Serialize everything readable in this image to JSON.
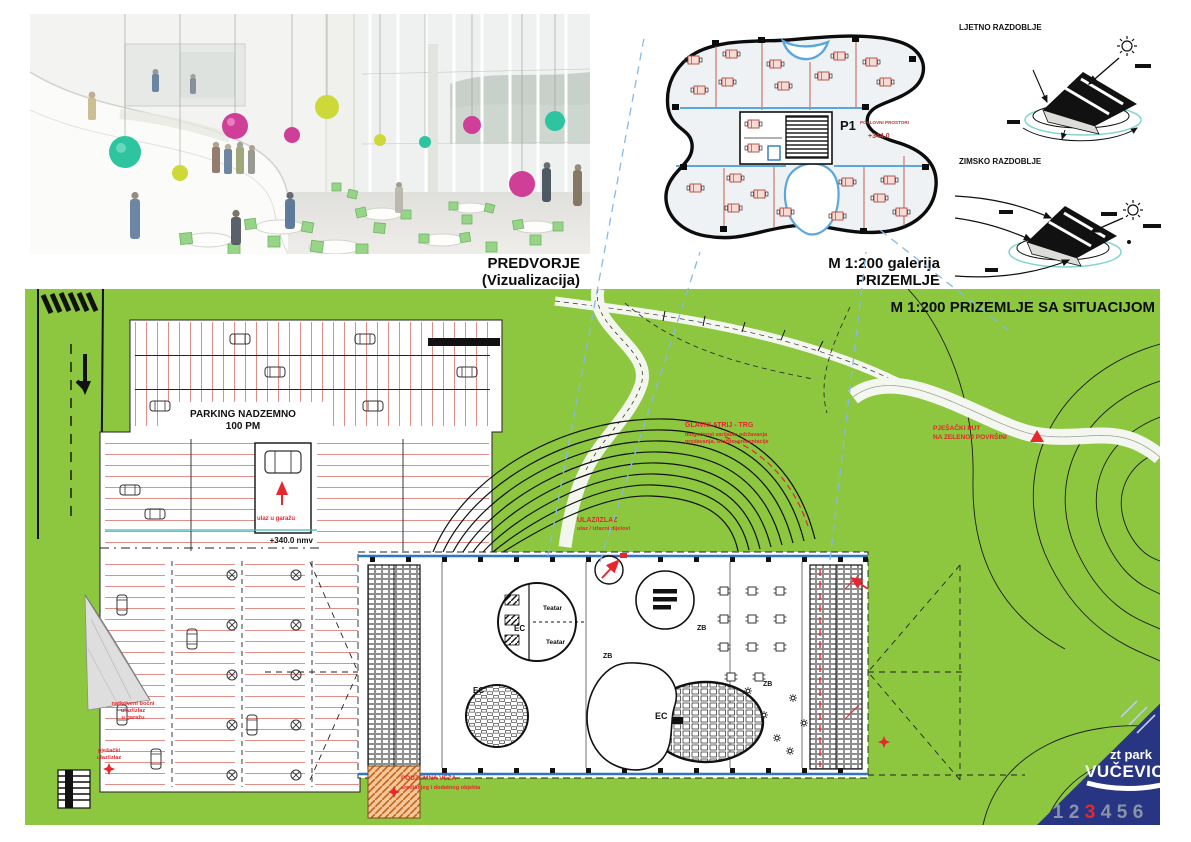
{
  "visualization": {
    "caption": "PREDVORJE (Vizualizacija)"
  },
  "gallery_plan": {
    "caption": "M 1:200  galerija PRIZEMLJE",
    "unit": "P1",
    "unit_sub": "POSLOVNI PROSTORI",
    "elevation": "+344.0"
  },
  "seasons": {
    "summer": "LJETNO RAZDOBLJE",
    "winter": "ZIMSKO RAZDOBLJE"
  },
  "site": {
    "title": "M 1:200  PRIZEMLJE SA SITUACIJOM",
    "parking_line1": "PARKING NADZEMNO",
    "parking_line2": "100 PM",
    "elevation": "+340.0 nmv",
    "entrance_title": "ULAZ/IZLAZ",
    "entrance_sub": "ulaz / izlazni dijelovi",
    "atrium_title": "GLAVNI ATRIJ - TRG",
    "atrium_sub1": "mogućnost varijable održavanja",
    "atrium_sub2": "predavanja, izložbe, prezentacije",
    "path_line1": "PJEŠAČKI PUT",
    "path_line2": "NA ZELENOJ POVRŠINI",
    "underground_title": "PODZEMNA VEZA",
    "underground_sub": "središnjeg i dodatnog objekta",
    "canopy_line1": "natkriveni bočni",
    "canopy_line2": "ulaz/izlaz",
    "canopy_line3": "u garažu",
    "pedestrian_line1": "pješački",
    "pedestrian_line2": "ulaz/izlaz",
    "ramp_label": "ulaz u garažu",
    "room_ec": "EC",
    "room_zb": "ZB",
    "room_teatar": "Teatar"
  },
  "logo": {
    "line1": "zt park",
    "line2": "VUČEVICA",
    "numbers": [
      "1",
      "2",
      "3",
      "4",
      "5",
      "6"
    ]
  },
  "colors": {
    "green": "#8dc63f",
    "navy": "#283583",
    "red": "#e8262d",
    "plan_blue": "#2e75c3"
  }
}
